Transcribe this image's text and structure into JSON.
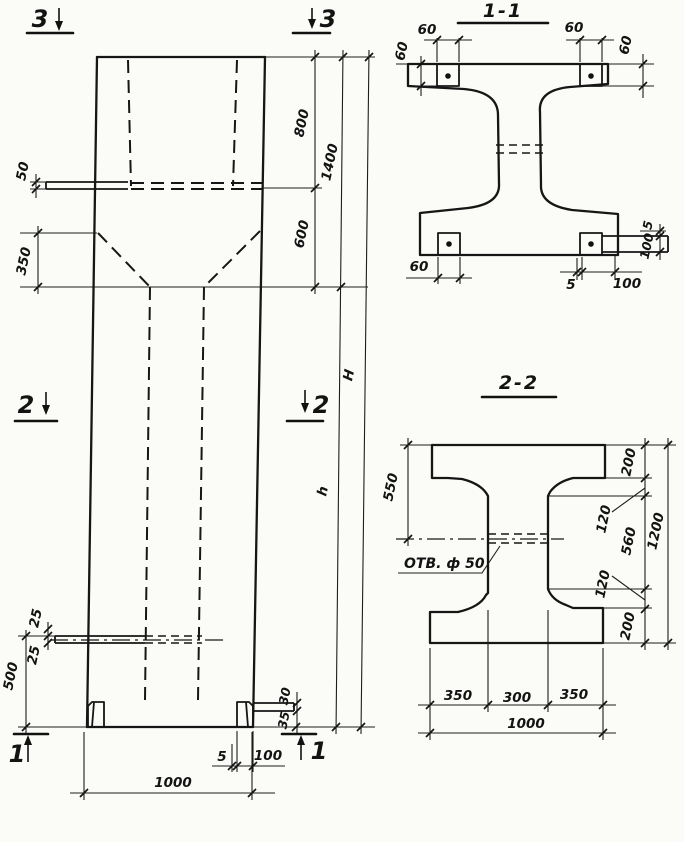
{
  "palette": {
    "ink": "#161616",
    "paper": "#fbfbf7"
  },
  "elevation": {
    "markers": {
      "top_left": "3",
      "top_right": "3",
      "mid_left": "2",
      "mid_right": "2",
      "bottom_left": "1",
      "bottom_right": "1"
    },
    "dims": {
      "ledge_plate_t": "50",
      "taper_height": "350",
      "top_block": "800",
      "top_total": "1400",
      "taper_zone": "600",
      "overall": "H",
      "shaft": "h",
      "rod_a": "25",
      "rod_b": "25",
      "base_zone": "500",
      "base_plate_a": "30",
      "base_plate_b": "35",
      "base_plate_t": "5",
      "base_plate_w": "100",
      "width": "1000"
    }
  },
  "section_1_1": {
    "title": "1-1",
    "dims": {
      "plate_tl_w": "60",
      "plate_tl_h": "60",
      "plate_tr_w": "60",
      "plate_tr_h": "60",
      "plate_bl_w": "60",
      "plate_br_t": "5",
      "plate_br_w": "100",
      "plate_r_t": "5",
      "plate_r_w": "100"
    }
  },
  "section_2_2": {
    "title": "2-2",
    "hole_label": "ОТВ. ф 50",
    "dims": {
      "flange_top": "550",
      "f200_top": "200",
      "f120_top": "120",
      "web": "560",
      "f120_bot": "120",
      "f200_bot": "200",
      "height": "1200",
      "bot_left": "350",
      "bot_mid": "300",
      "bot_right": "350",
      "bot_total": "1000"
    }
  }
}
